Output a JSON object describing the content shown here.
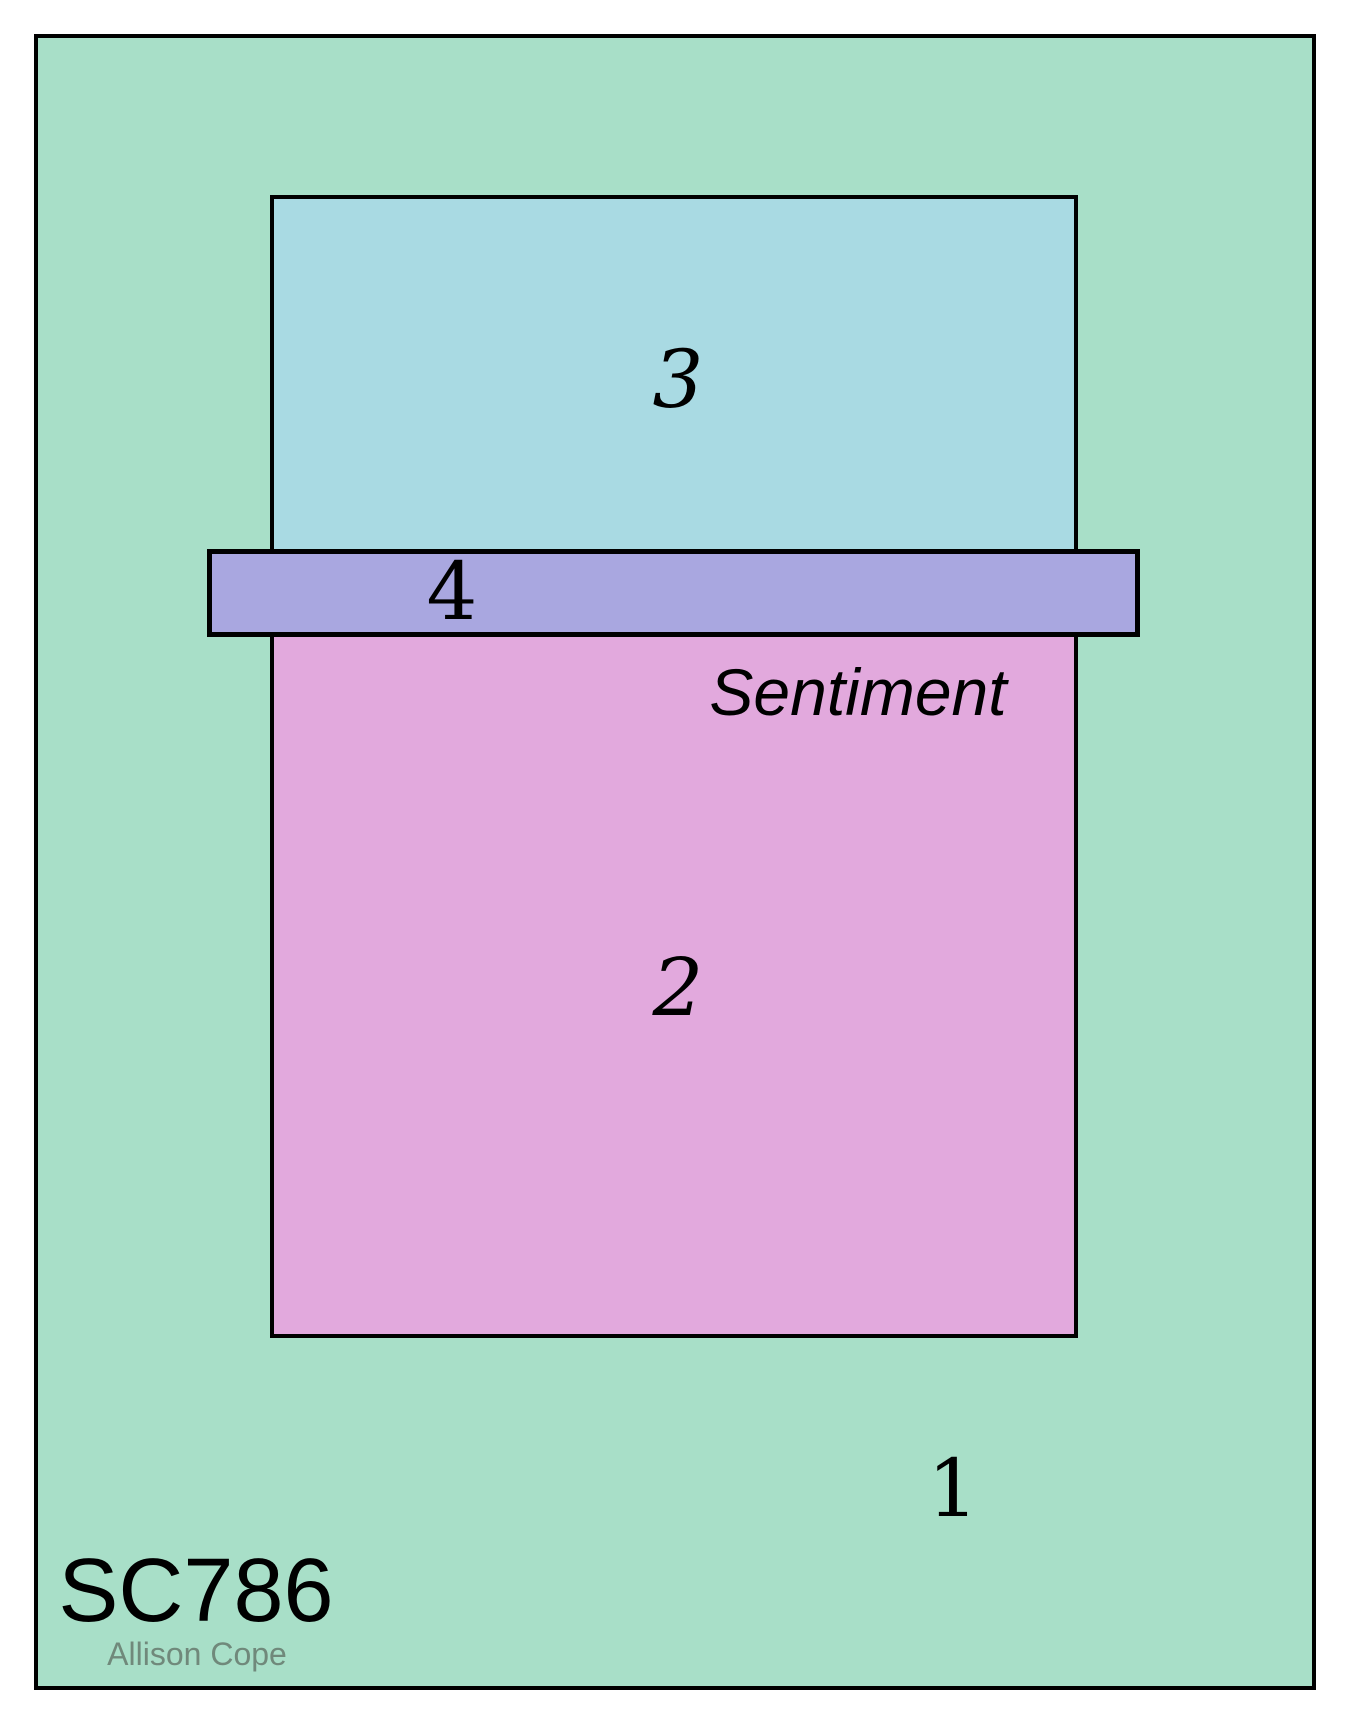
{
  "sketch": {
    "code": "SC786",
    "author": "Allison Cope",
    "labels": {
      "layer1": "1",
      "layer2": "2",
      "layer3": "3",
      "layer4": "4",
      "sentiment": "Sentiment"
    },
    "colors": {
      "card_base": "#a8dfc8",
      "photo_panel": "#a9dae3",
      "main_panel": "#e2a9dd",
      "sentiment_strip": "#a9a7e0",
      "outline": "#000000",
      "code_text": "#000000",
      "author_text": "#70897b"
    }
  }
}
